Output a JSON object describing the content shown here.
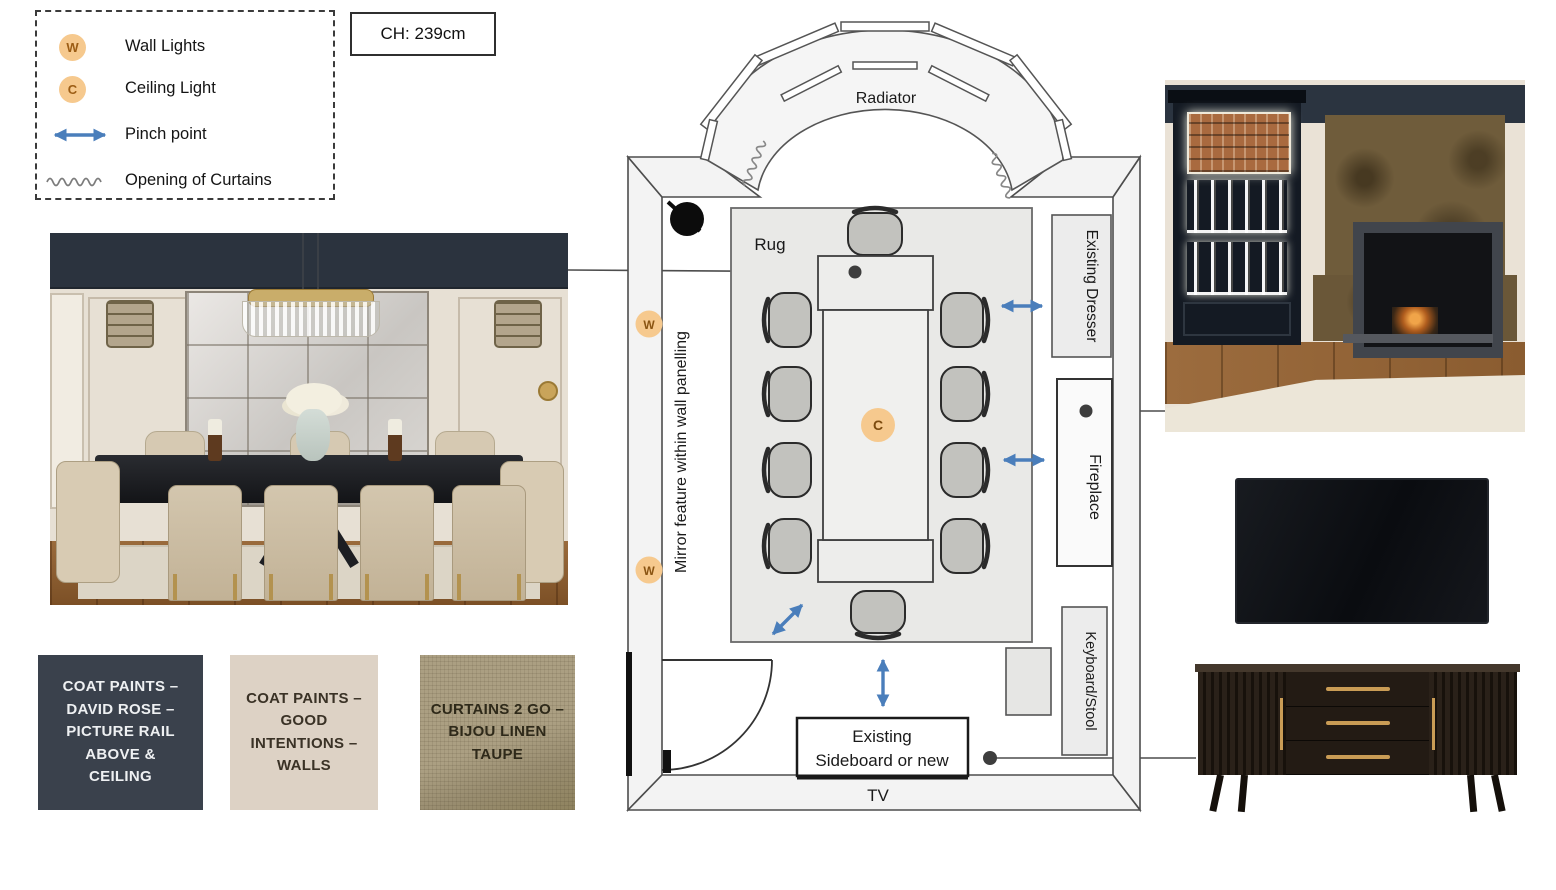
{
  "legend": {
    "items": [
      {
        "symbol": "W",
        "label": "Wall Lights"
      },
      {
        "symbol": "C",
        "label": "Ceiling Light"
      },
      {
        "label": "Pinch point"
      },
      {
        "label": "Opening of Curtains"
      }
    ]
  },
  "ch_box": {
    "label": "CH: 239cm"
  },
  "floorplan": {
    "radiator_label": "Radiator",
    "rug_label": "Rug",
    "wall_light_symbol": "W",
    "ceiling_light_symbol": "C",
    "mirror_note": "Mirror feature within wall panelling",
    "dresser_label": "Existing Dresser",
    "fireplace_label": "Fireplace",
    "keyboard_label": "Keyboard/Stool",
    "sideboard_label_line1": "Existing",
    "sideboard_label_line2": "Sideboard or new",
    "tv_label": "TV"
  },
  "swatches": [
    {
      "text": "COAT PAINTS –\nDAVID ROSE –\nPICTURE RAIL\nABOVE &\nCEILING",
      "bg": "#3a414c",
      "fg": "#eef0f2"
    },
    {
      "text": "COAT PAINTS –\nGOOD\nINTENTIONS –\nWALLS",
      "bg": "#ddd2c5",
      "fg": "#3a3226"
    },
    {
      "text": "CURTAINS 2 GO –\nBIJOU LINEN\nTAUPE",
      "bg": "#a89d80",
      "fg": "#2e2919"
    }
  ],
  "colors": {
    "symbol_orange": "#f6c98e",
    "arrow_blue": "#4a7ebb",
    "navy_band": "#2b333e",
    "wall_gray": "#f3f3f3",
    "rug_gray": "#e9e9e7"
  }
}
